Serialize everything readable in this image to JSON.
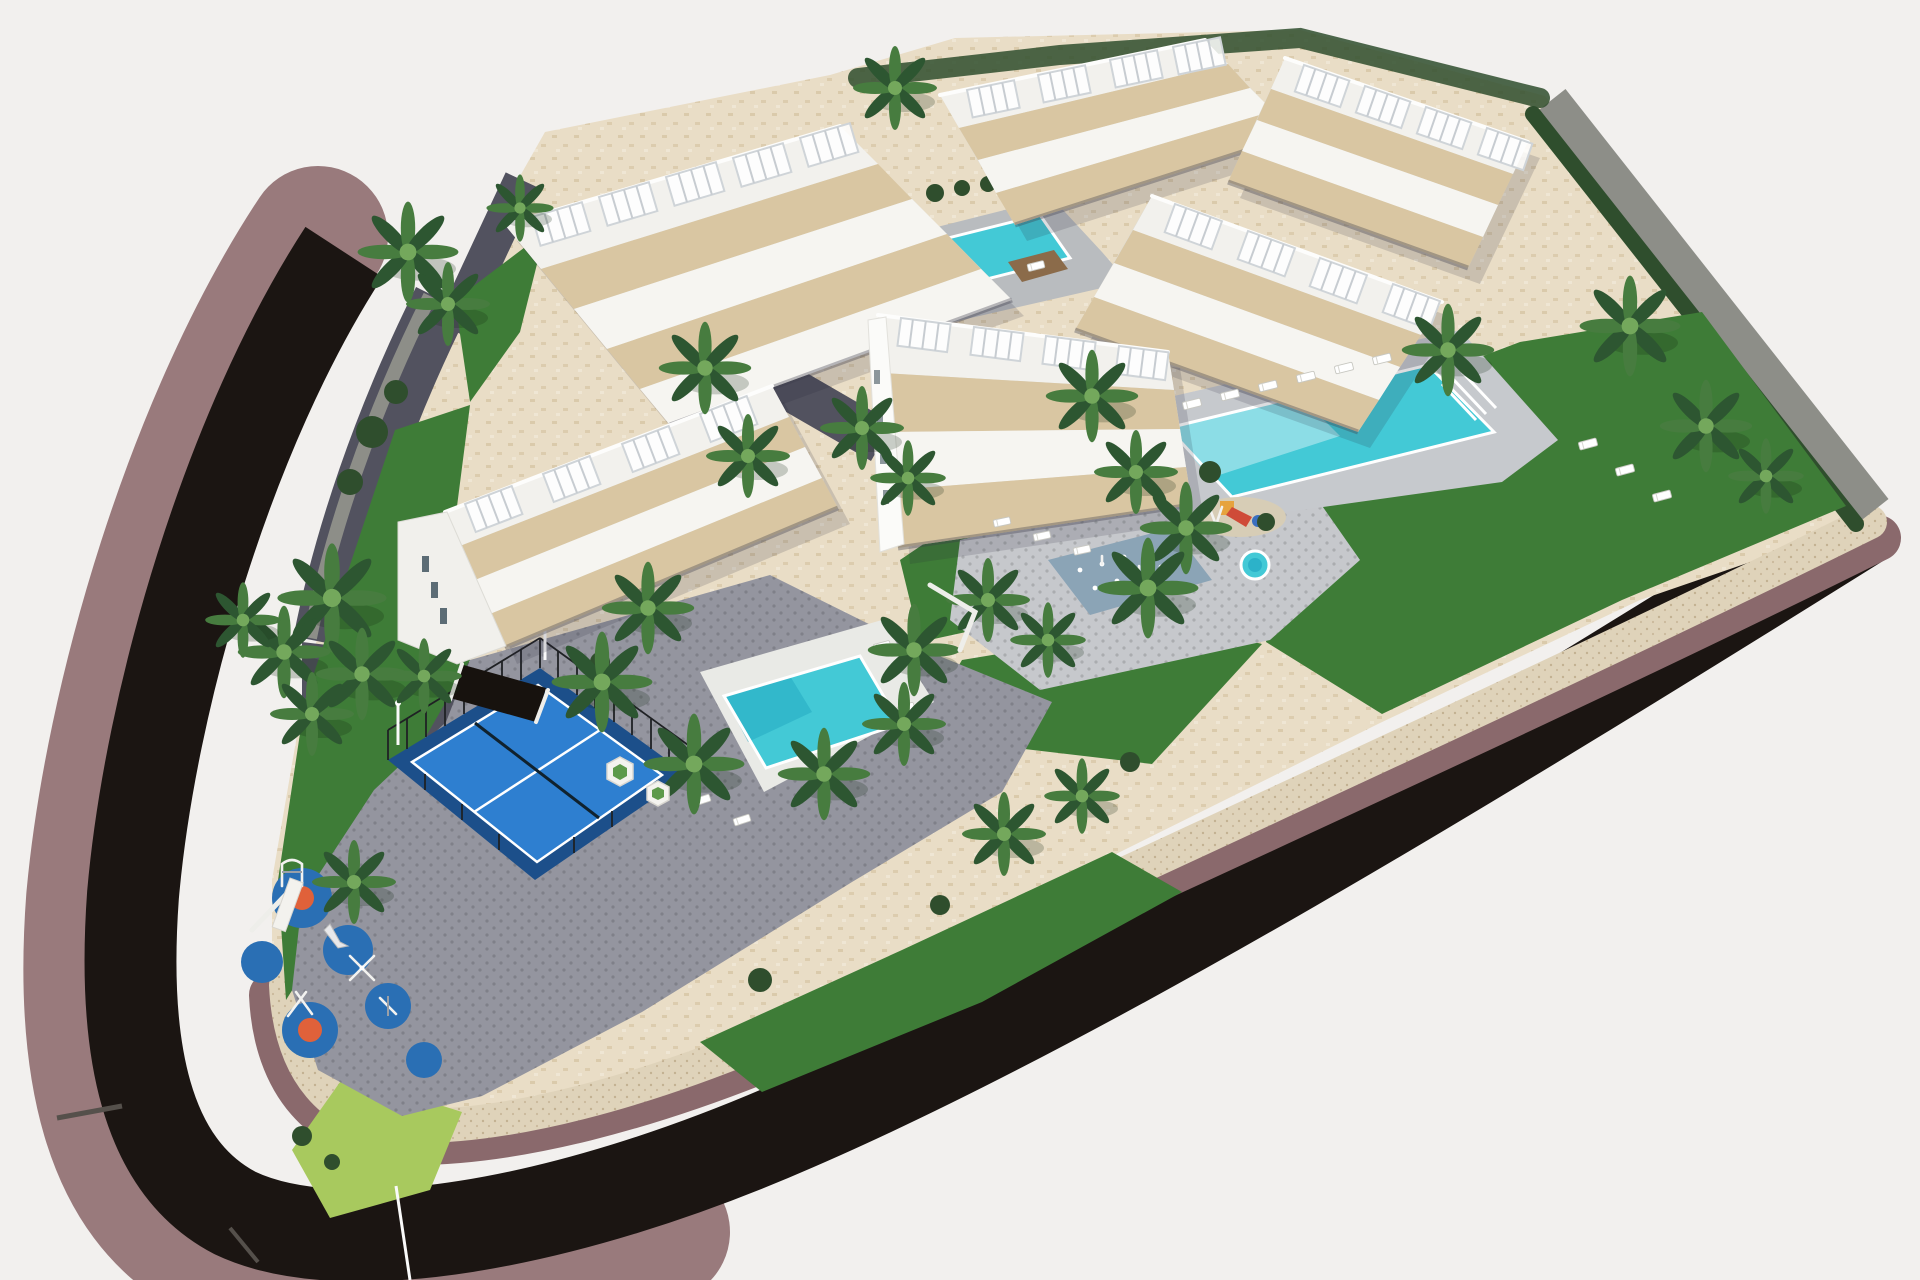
{
  "meta": {
    "title": "Aerial 3D render of a terraced coastal apartment development",
    "description": "Photorealistic isometric aerial architectural visualization: six white terraced apartment blocks with rooftop pergolas on an elevated triangular parcel, three turquoise swimming pools, splash pad, padel court, children playground with blue rubber pads, palm gardens, and a dark curved perimeter road with mauve sidewalks on a plain light backdrop.",
    "render_style": "3D exterior render, oblique top-down view",
    "background": "plain light-gray studio backdrop"
  },
  "palette": {
    "bg": "#f2f0ee",
    "road": "#1b1512",
    "road_joint": "#55504b",
    "sidewalk": "#997a7c",
    "sidewalk_dark": "#8a696c",
    "path_cream": "#dfd3ba",
    "path_speckle": "#c3ae8c",
    "paving_beige": "#e9ddc6",
    "paving_gray": "#94959f",
    "paving_light": "#c6c8cc",
    "cobble": "#52525f",
    "stone_wall": "#8d8e88",
    "hedge": "#2f4e2d",
    "lawn": "#3e7c37",
    "lawn_bright": "#5d9a4b",
    "lawn_lime": "#a8c95e",
    "pool": "#43c9d6",
    "pool_light": "#9fe2ea",
    "pool_deep": "#1ea3bf",
    "wood_deck": "#8b6b4a",
    "padel_blue": "#2e7fd0",
    "padel_surround": "#1c4f8a",
    "fence": "#1f2124",
    "play_pad": "#2a6fb4",
    "play_orange": "#e0613a",
    "building_white": "#f8f7f4",
    "building_shade": "#dddcd6",
    "terrace": "#d9c6a2",
    "glass": "#5c6c75",
    "palm_dark": "#2d5631",
    "palm_mid": "#477c3f",
    "palm_light": "#74a85c",
    "trunk": "#8a795d"
  },
  "scene": {
    "road": {
      "label": "curved perimeter asphalt road with mauve sidewalks",
      "surface": "dark asphalt"
    },
    "site": {
      "label": "elevated triangular development parcel",
      "boundary": "stone retaining walls with cream stone path edge"
    },
    "buildings": [
      {
        "id": "block-a",
        "label": "apartment block A - top left, four terraced levels, rooftop pergolas"
      },
      {
        "id": "block-b",
        "label": "apartment block B - top centre, rooftop pergolas"
      },
      {
        "id": "block-c",
        "label": "apartment block C - top right corner"
      },
      {
        "id": "block-d",
        "label": "apartment block D - mid right, above main community pool"
      },
      {
        "id": "block-e",
        "label": "apartment block E - centre, white gable wall"
      },
      {
        "id": "block-f",
        "label": "apartment block F - west, with street-level garage entrance"
      }
    ],
    "pools": [
      {
        "id": "pool-top",
        "label": "upper terrace lap pool with timber deck island"
      },
      {
        "id": "pool-right",
        "label": "main community pool with entry steps and timber sun platform"
      },
      {
        "id": "pool-left",
        "label": "west garden pool"
      },
      {
        "id": "kids-round-pool",
        "label": "small round kids pool"
      },
      {
        "id": "splash-pad",
        "label": "water-jet splash pad"
      }
    ],
    "amenities": [
      {
        "id": "padel-court",
        "label": "fenced padel court with blue playing surface"
      },
      {
        "id": "central-playground",
        "label": "children playground with slide tower, dome and swings"
      },
      {
        "id": "outdoor-gym",
        "label": "outdoor gym and play pads on the south plaza"
      },
      {
        "id": "entrance-gate",
        "label": "pedestrian entrance gate pillar on west sidewalk"
      },
      {
        "id": "palm-garden",
        "label": "palm trees and hedges across the gardens"
      }
    ],
    "counts": {
      "buildings": 6,
      "swimming_pools": 3,
      "kids_pools": 2,
      "padel_courts": 1,
      "playgrounds": 2,
      "palm_trees": 32,
      "sun_loungers": 17
    }
  }
}
